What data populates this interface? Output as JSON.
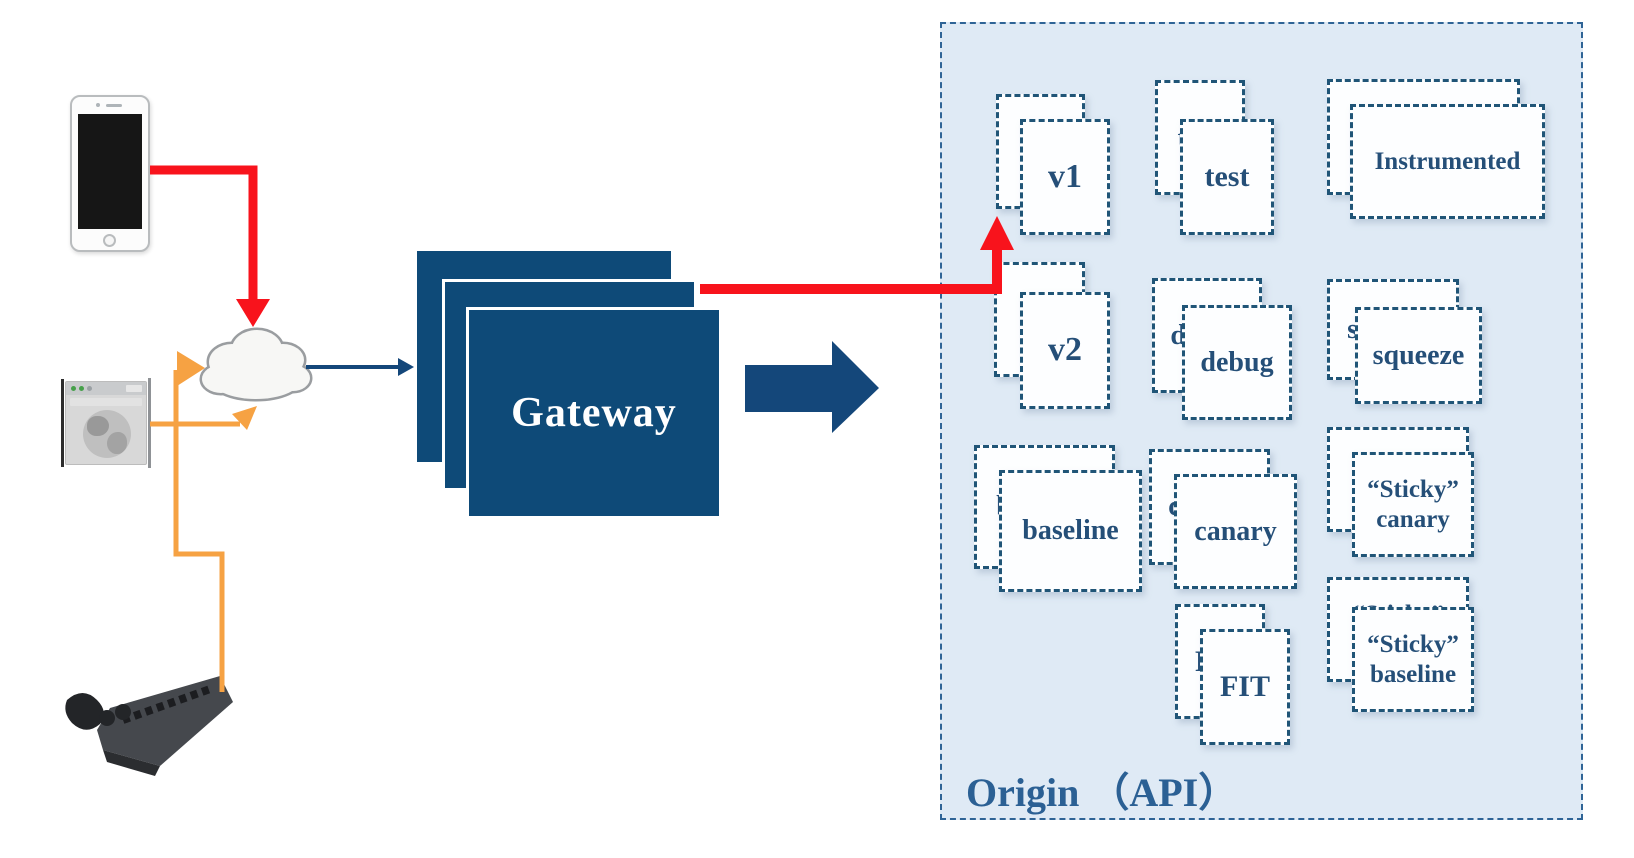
{
  "gateway": {
    "label": "Gateway"
  },
  "origin": {
    "label": "Origin （API）",
    "stacks": [
      {
        "id": "v1",
        "label": "v1"
      },
      {
        "id": "test",
        "label": "test"
      },
      {
        "id": "instrumented",
        "label": "Instrumented"
      },
      {
        "id": "v2",
        "label": "v2"
      },
      {
        "id": "debug",
        "label": "debug"
      },
      {
        "id": "squeeze",
        "label": "squeeze"
      },
      {
        "id": "baseline",
        "label": "baseline"
      },
      {
        "id": "canary",
        "label": "canary"
      },
      {
        "id": "sticky-canary",
        "label": "“Sticky”\ncanary"
      },
      {
        "id": "fit",
        "label": "FIT"
      },
      {
        "id": "sticky-baseline",
        "label": "“Sticky”\nbaseline"
      }
    ]
  },
  "icons": [
    {
      "name": "smartphone-icon"
    },
    {
      "name": "web-browser-icon"
    },
    {
      "name": "game-console-icon"
    },
    {
      "name": "cloud-icon"
    }
  ],
  "colors": {
    "accent_red": "#f8131c",
    "accent_orange": "#f6a243",
    "navy_arrow": "#14477a",
    "gateway_fill": "#0e4a78",
    "gateway_text": "#ffffff",
    "origin_fill": "#dfeaf5",
    "origin_border": "#2f6496",
    "card_border": "#205577",
    "card_text": "#254f78",
    "origin_label_color": "#2b6094"
  }
}
